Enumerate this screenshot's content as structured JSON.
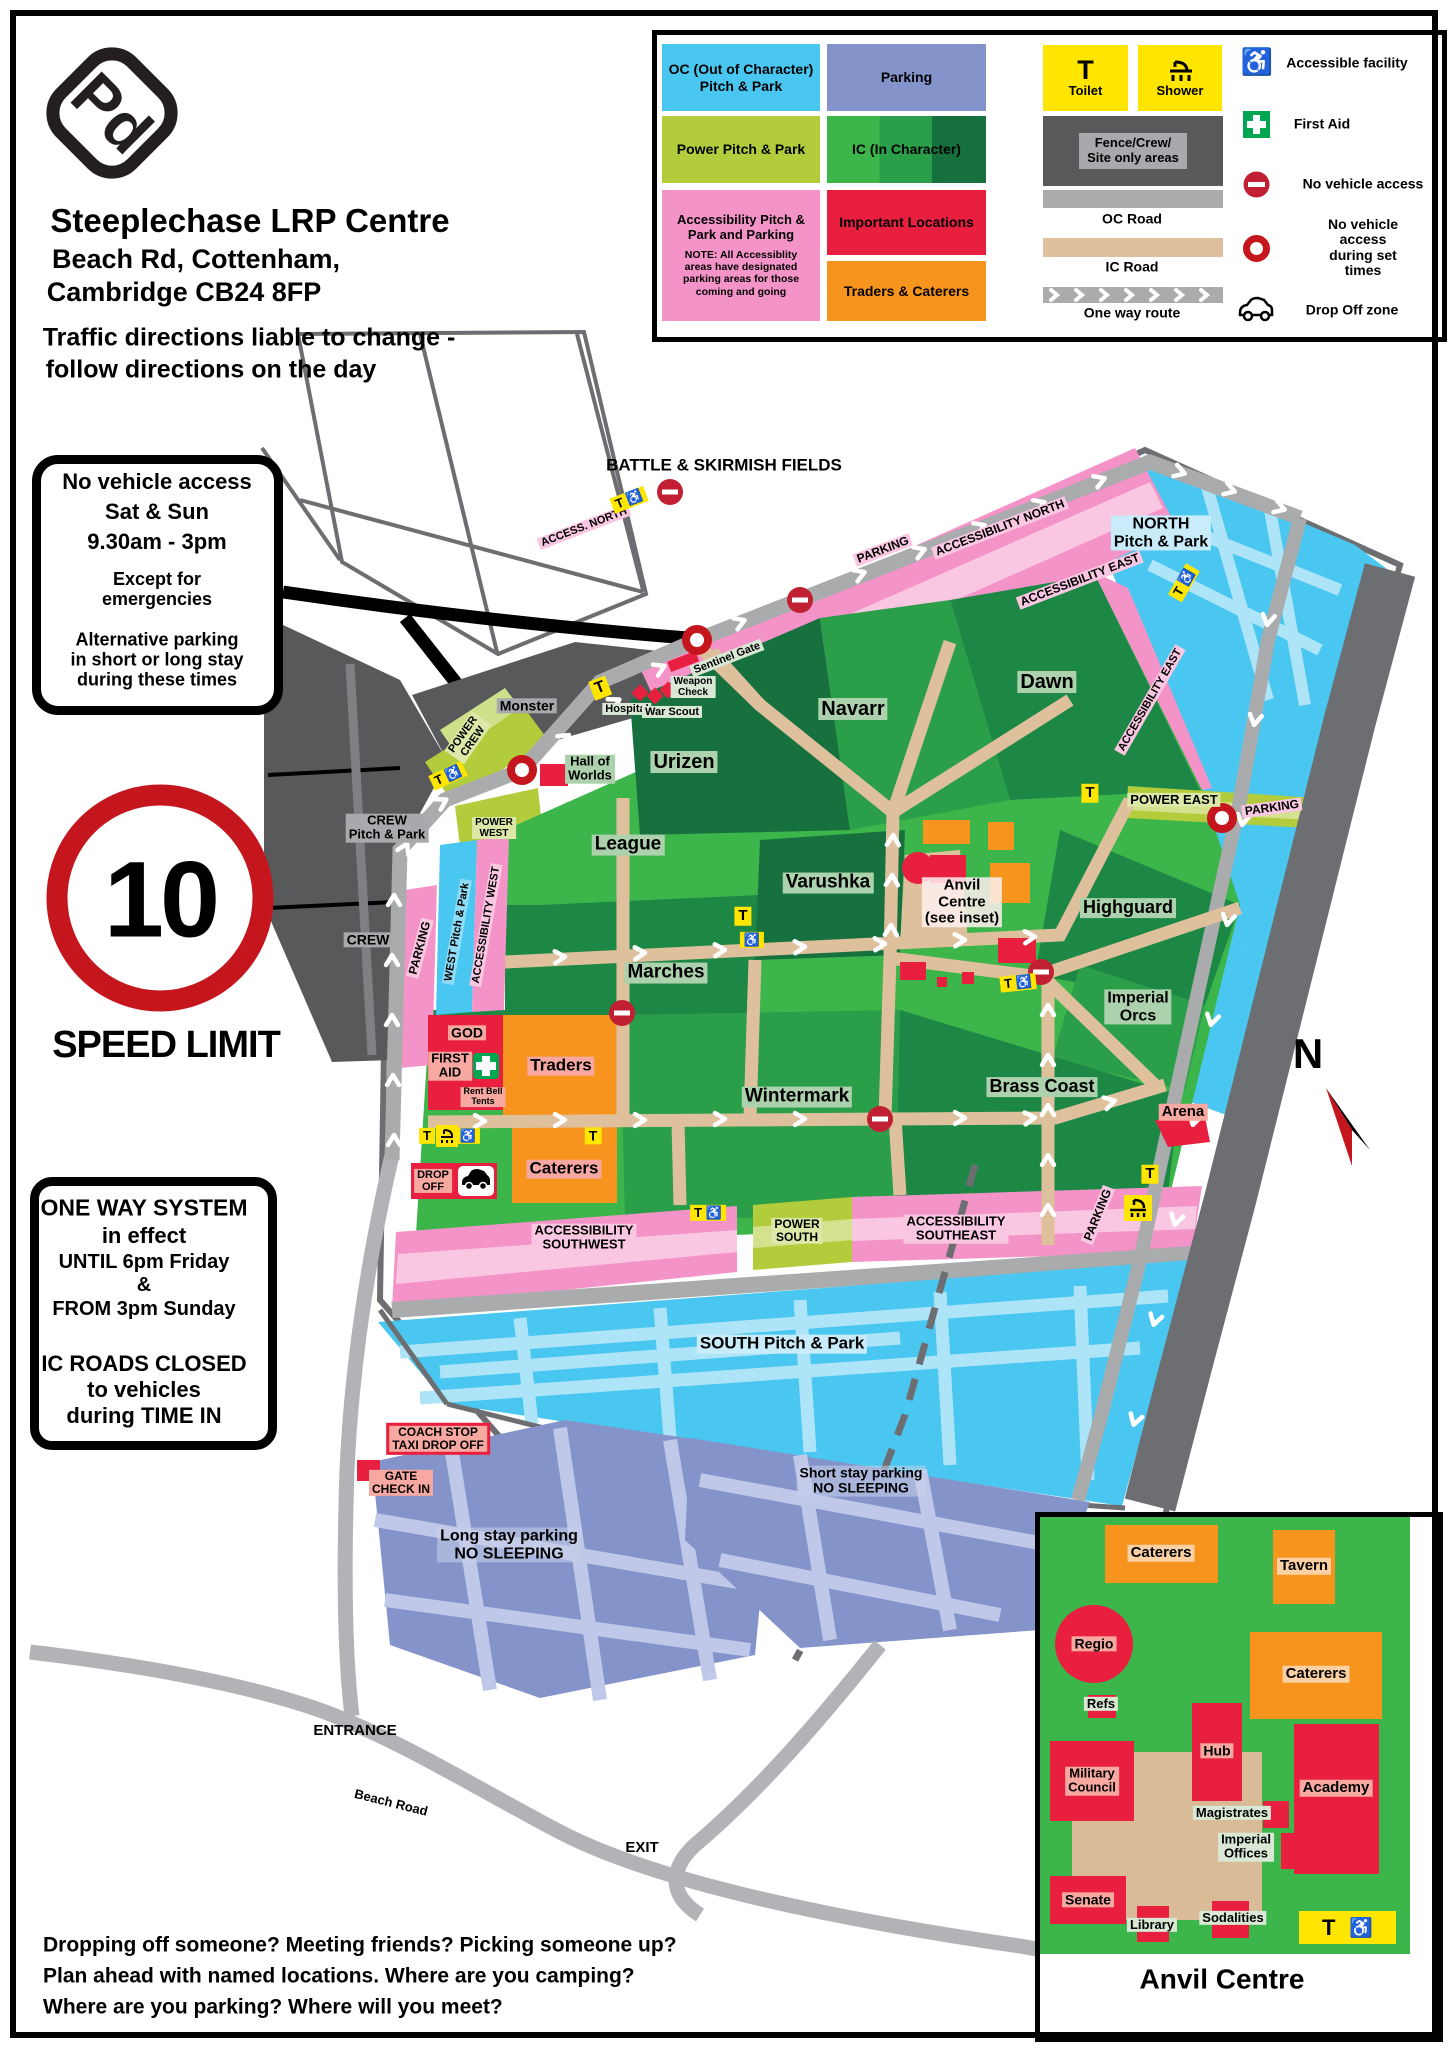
{
  "header": {
    "logo_text": "Pd",
    "title": "Steeplechase LRP Centre",
    "address_line1": "Beach Rd, Cottenham,",
    "address_line2": "Cambridge CB24 8FP",
    "traffic_note_line1": "Traffic directions liable to change -",
    "traffic_note_line2": "follow directions on the day"
  },
  "legend": {
    "oc_pitch_park": "OC (Out of Character)\nPitch & Park",
    "parking": "Parking",
    "power_pitch_park": "Power Pitch & Park",
    "ic_in_character": "IC (In Character)",
    "accessibility_pitch": "Accessibility Pitch &\nPark and Parking",
    "accessibility_note": "NOTE: All Accessiblity\nareas have designated\nparking areas for those\ncoming and going",
    "important_locations": "Important Locations",
    "traders_caterers": "Traders & Caterers",
    "toilet": "Toilet",
    "shower": "Shower",
    "fence_crew": "Fence/Crew/\nSite only areas",
    "oc_road": "OC Road",
    "ic_road": "IC Road",
    "one_way_route": "One way route",
    "accessible_facility": "Accessible facility",
    "first_aid": "First Aid",
    "no_vehicle_access": "No vehicle access",
    "no_vehicle_set_times": "No vehicle access\nduring set times",
    "drop_off_zone": "Drop Off zone"
  },
  "signs": {
    "no_access_line1": "No vehicle access",
    "no_access_line2": "Sat & Sun",
    "no_access_line3": "9.30am - 3pm",
    "no_access_line4": "Except for\nemergencies",
    "no_access_line5": "Alternative parking\nin short or long stay\nduring these times",
    "speed_value": "10",
    "speed_label": "SPEED LIMIT",
    "one_way_line1": "ONE WAY SYSTEM",
    "one_way_line2": "in effect",
    "one_way_line3": "UNTIL 6pm Friday",
    "one_way_line4": "&",
    "one_way_line5": "FROM 3pm Sunday",
    "one_way_line6": "IC ROADS CLOSED",
    "one_way_line7": "to vehicles",
    "one_way_line8": "during TIME IN"
  },
  "map": {
    "battle_fields": "BATTLE & SKIRMISH FIELDS",
    "access_north": "ACCESS. NORTH",
    "accessibility_north": "ACCESSIBILITY NORTH",
    "parking_north": "PARKING",
    "north_pitch": "NORTH\nPitch & Park",
    "accessibility_east_upper": "ACCESSIBILITY EAST",
    "accessibility_east_lower": "ACCESSIBILITY EAST",
    "sentinel_gate": "Sentinel Gate",
    "monster": "Monster",
    "hospital": "Hospital",
    "war_scout": "War Scout",
    "weapon_check": "Weapon\nCheck",
    "hall_of_worlds": "Hall of\nWorlds",
    "urizen": "Urizen",
    "navarr": "Navarr",
    "dawn": "Dawn",
    "power_crew": "POWER\nCREW",
    "crew_pitch_park": "CREW\nPitch & Park",
    "crew": "CREW",
    "parking_west": "PARKING",
    "west_pitch_park": "WEST Pitch & Park",
    "accessibility_west": "ACCESSIBILITY WEST",
    "power_west": "POWER\nWEST",
    "power_east": "POWER EAST",
    "parking_east": "PARKING",
    "league": "League",
    "varushka": "Varushka",
    "marches": "Marches",
    "anvil_centre": "Anvil\nCentre\n(see inset)",
    "highguard": "Highguard",
    "imperial_orcs": "Imperial\nOrcs",
    "wintermark": "Wintermark",
    "brass_coast": "Brass Coast",
    "arena": "Arena",
    "god": "GOD",
    "first_aid": "FIRST\nAID",
    "rent_bell_tents": "Rent Bell\nTents",
    "traders": "Traders",
    "caterers": "Caterers",
    "drop_off": "DROP\nOFF",
    "parking_se_side": "PARKING",
    "accessibility_southwest": "ACCESSIBILITY\nSOUTHWEST",
    "power_south": "POWER\nSOUTH",
    "accessibility_southeast": "ACCESSIBILITY\nSOUTHEAST",
    "south_pitch": "SOUTH Pitch & Park",
    "coach_stop": "COACH STOP\nTAXI DROP OFF",
    "gate_check_in": "GATE\nCHECK IN",
    "long_stay": "Long stay parking\nNO SLEEPING",
    "short_stay": "Short stay parking\nNO SLEEPING",
    "entrance": "ENTRANCE",
    "beach_road": "Beach Road",
    "exit": "EXIT",
    "north_letter": "N"
  },
  "icons": {
    "toilet": "T",
    "wheelchair": "♿"
  },
  "inset": {
    "title": "Anvil Centre",
    "caterers_top": "Caterers",
    "tavern": "Tavern",
    "regio": "Regio",
    "refs": "Refs",
    "caterers_right": "Caterers",
    "hub": "Hub",
    "military_council": "Military\nCouncil",
    "academy": "Academy",
    "magistrates": "Magistrates",
    "imperial_offices": "Imperial\nOffices",
    "senate": "Senate",
    "library": "Library",
    "sodalities": "Sodalities"
  },
  "footer": {
    "line1": "Dropping off someone? Meeting friends? Picking someone up?",
    "line2": "Plan ahead with named locations. Where are you camping?",
    "line3": "Where are you parking? Where will you meet?"
  },
  "colors": {
    "oc_cyan": "#4ac7f0",
    "parking_periwinkle": "#8494cb",
    "power_green": "#b2cc3c",
    "ic_green_bright": "#3cb54a",
    "ic_green_mid": "#2b9e4a",
    "ic_green_dark": "#17713f",
    "accessibility_pink": "#f493c8",
    "important_red": "#e81f3f",
    "traders_orange": "#f7941e",
    "ic_road_tan": "#dfc09c",
    "oc_road_grey": "#a9abac",
    "crew_dark_grey": "#58595b",
    "site_border_grey": "#6d6e71",
    "toilet_yellow": "#ffe600",
    "sign_red": "#c4161c"
  }
}
